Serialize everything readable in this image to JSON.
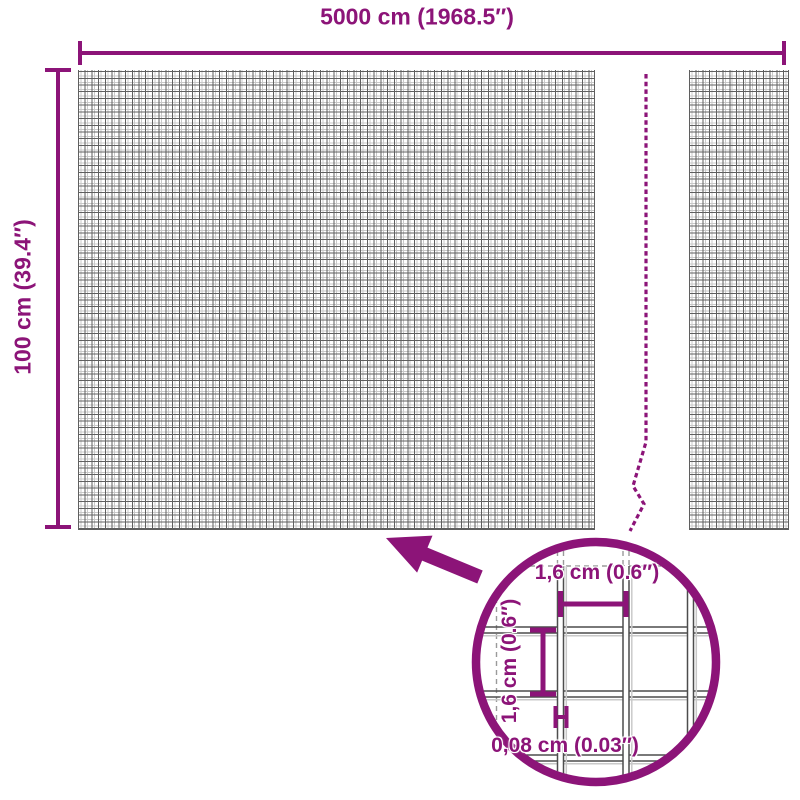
{
  "accent_color": "#8C1478",
  "mesh_color_dark": "#5F5F5F",
  "mesh_color_light": "#C9C9C9",
  "main_diagram": {
    "width_label": "5000 cm (1968.5″)",
    "height_label": "100 cm (39.4″)"
  },
  "detail_view": {
    "mesh_opening_width_label": "1,6 cm (0.6″)",
    "mesh_opening_height_label": "1,6 cm (0.6″)",
    "wire_thickness_label": "0,08 cm (0.03″)"
  }
}
